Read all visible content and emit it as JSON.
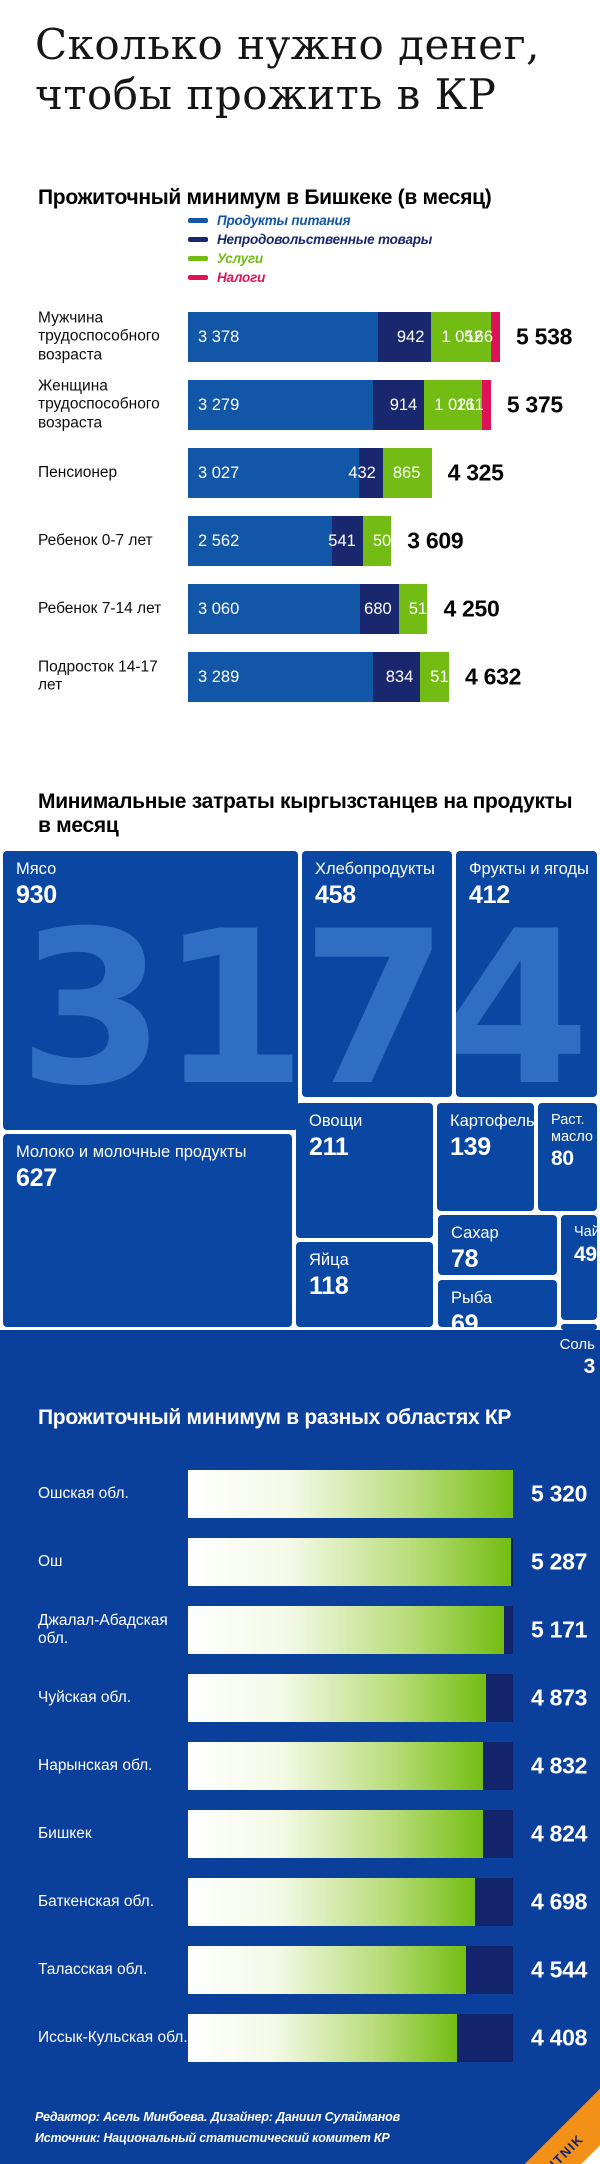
{
  "title": "Сколько нужно денег,\nчтобы прожить в КР",
  "colors": {
    "food_blue": "#1256a8",
    "nonfood_navy": "#19276f",
    "services_green": "#72bc14",
    "taxes_red": "#e01257",
    "section_bg_blue": "#0a3f9c",
    "treemap_box_blue": "#0a47a3",
    "region_track_navy": "#13246d",
    "region_bar_green": "#74bd13",
    "brand_orange": "#f29018"
  },
  "chart_data": [
    {
      "type": "bar",
      "subtype": "horizontal-stacked",
      "title": "Прожиточный минимум в Бишкеке (в месяц)",
      "legend_position": "top",
      "legend": [
        {
          "label": "Продукты питания",
          "color": "#1256a8"
        },
        {
          "label": "Непродовольственные товары",
          "color": "#19276f"
        },
        {
          "label": "Услуги",
          "color": "#72bc14"
        },
        {
          "label": "Налоги",
          "color": "#e01257"
        }
      ],
      "rows": [
        {
          "category": "Мужчина трудоспособного возраста",
          "segments": [
            3378,
            942,
            1052,
            166
          ],
          "segment_labels": [
            "3 378",
            "942",
            "1 052",
            "166"
          ],
          "total": 5538,
          "total_label": "5 538"
        },
        {
          "category": "Женщина трудоспособного возраста",
          "segments": [
            3279,
            914,
            1021,
            161
          ],
          "segment_labels": [
            "3 279",
            "914",
            "1 021",
            "161"
          ],
          "total": 5375,
          "total_label": "5 375"
        },
        {
          "category": "Пенсионер",
          "segments": [
            3027,
            432,
            865
          ],
          "segment_labels": [
            "3 027",
            "432",
            "865"
          ],
          "total": 4325,
          "total_label": "4 325"
        },
        {
          "category": "Ребенок 0-7 лет",
          "segments": [
            2562,
            541,
            505
          ],
          "segment_labels": [
            "2 562",
            "541",
            "505"
          ],
          "total": 3609,
          "total_label": "3 609"
        },
        {
          "category": "Ребенок 7-14 лет",
          "segments": [
            3060,
            680,
            510
          ],
          "segment_labels": [
            "3 060",
            "680",
            "510"
          ],
          "total": 4250,
          "total_label": "4 250"
        },
        {
          "category": "Подросток 14-17 лет",
          "segments": [
            3289,
            834,
            510
          ],
          "segment_labels": [
            "3 289",
            "834",
            "510"
          ],
          "total": 4632,
          "total_label": "4 632"
        }
      ]
    },
    {
      "type": "heatmap",
      "subtype": "treemap",
      "title": "Минимальные затраты кыргызстанцев на продукты в месяц",
      "watermark": "3174 с",
      "items": [
        {
          "label": "Мясо",
          "value": 930
        },
        {
          "label": "Хлебопродукты",
          "value": 458
        },
        {
          "label": "Фрукты и ягоды",
          "value": 412
        },
        {
          "label": "Молоко и молочные продукты",
          "value": 627
        },
        {
          "label": "Овощи",
          "value": 211
        },
        {
          "label": "Картофель",
          "value": 139
        },
        {
          "label": "Раст. масло",
          "value": 80
        },
        {
          "label": "Яйца",
          "value": 118
        },
        {
          "label": "Сахар",
          "value": 78
        },
        {
          "label": "Рыба",
          "value": 69
        },
        {
          "label": "Чай",
          "value": 49
        },
        {
          "label": "Соль",
          "value": 3
        }
      ]
    },
    {
      "type": "bar",
      "subtype": "horizontal-gradient",
      "title": "Прожиточный минимум в разных областях КР",
      "xlim": [
        0,
        5320
      ],
      "categories": [
        "Ошская обл.",
        "Ош",
        "Джалал-Абадская обл.",
        "Чуйская обл.",
        "Нарынская обл.",
        "Бишкек",
        "Баткенская обл.",
        "Таласская обл.",
        "Иссык-Кульская обл."
      ],
      "values": [
        5320,
        5287,
        5171,
        4873,
        4832,
        4824,
        4698,
        4544,
        4408
      ],
      "value_labels": [
        "5 320",
        "5 287",
        "5 171",
        "4 873",
        "4 832",
        "4 824",
        "4 698",
        "4 544",
        "4 408"
      ]
    }
  ],
  "footer": {
    "credits": "Редактор: Асель Минбоева. Дизайнер: Даниил Сулайманов",
    "source": "Источник: Национальный статистический комитет КР",
    "brand": "SPUTNIK"
  }
}
